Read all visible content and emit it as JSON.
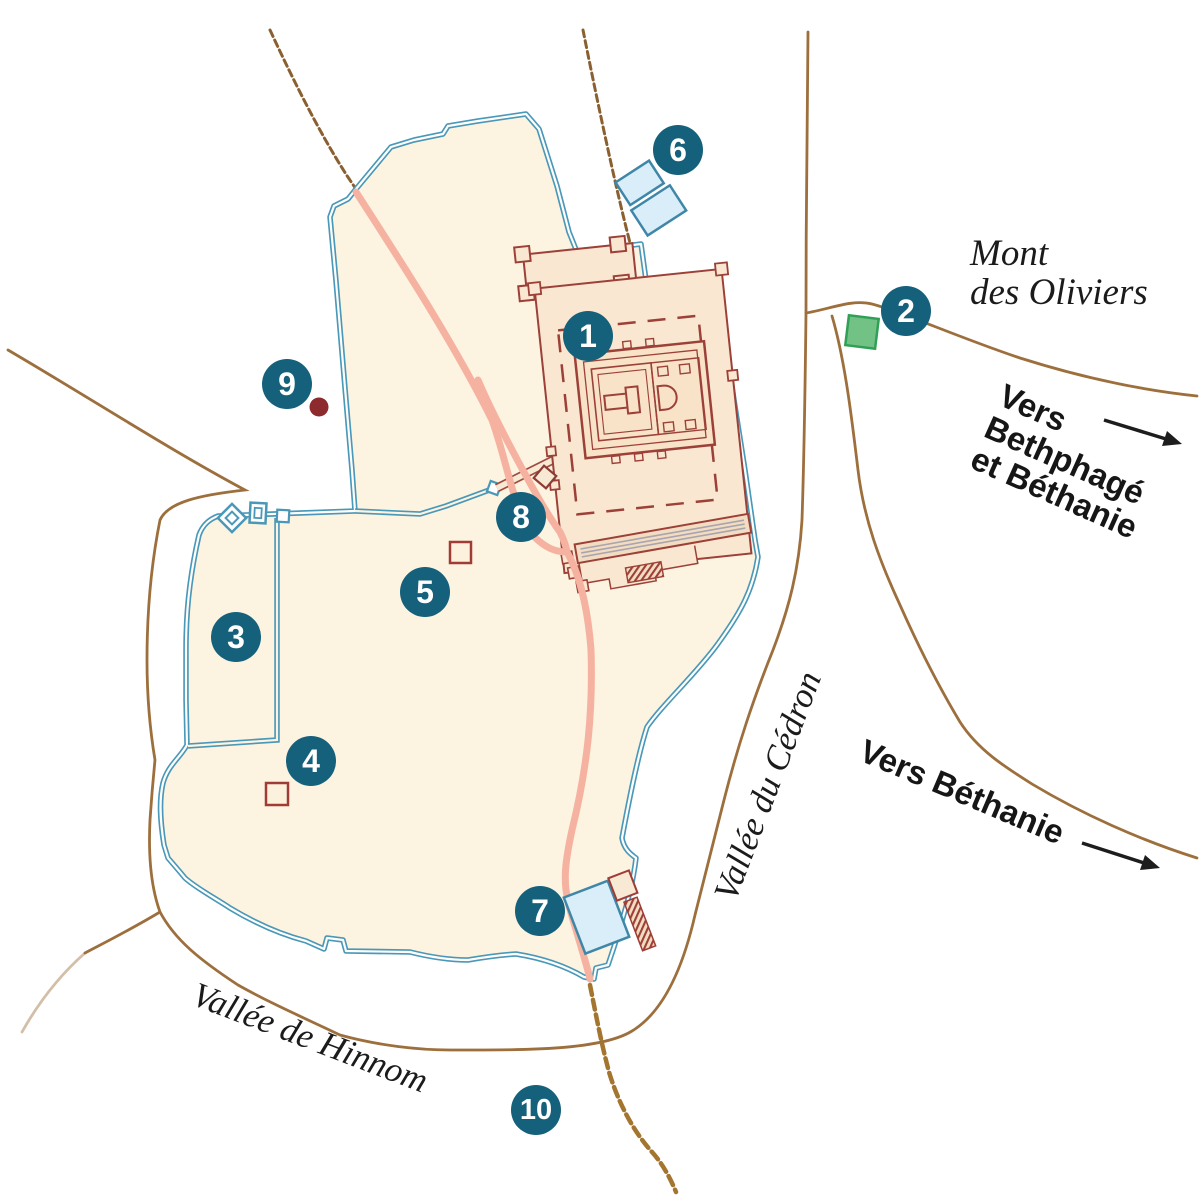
{
  "map": {
    "labels": {
      "mont_des_oliviers": [
        "Mont",
        "des Oliviers"
      ],
      "vers_bethphage_bethanie": [
        "Vers",
        "Bethphagé",
        "et Béthanie"
      ],
      "vers_bethanie": "Vers Béthanie",
      "vallee_du_cedron": "Vallée du Cédron",
      "vallee_de_hinnom": "Vallée de Hinnom"
    },
    "markers": [
      {
        "number": "1"
      },
      {
        "number": "2"
      },
      {
        "number": "3"
      },
      {
        "number": "4"
      },
      {
        "number": "5"
      },
      {
        "number": "6"
      },
      {
        "number": "7"
      },
      {
        "number": "8"
      },
      {
        "number": "9"
      },
      {
        "number": "10"
      }
    ],
    "colors": {
      "marker_background": "#15607b",
      "marker_text": "#ffffff",
      "city_fill": "#fdf3e1",
      "wall_blue": "#4a98b8",
      "temple_maroon": "#9c4038",
      "temple_fill": "#f9e7d1",
      "road_brown": "#9d6f3d",
      "road_dashed_brown": "#a3752f",
      "road_pink": "#f6b2a0",
      "pool_fill": "#daeefa",
      "pool_border": "#3f87a8",
      "green_square_fill": "#72c185",
      "green_square_border": "#2fa056",
      "red_dot": "#8c2a2e",
      "red_square_border": "#a03c36",
      "label_text": "#1b1b1b"
    },
    "symbols": [
      "temple-complex",
      "antonia-fortress",
      "royal-stoa",
      "twin-pools",
      "siloam-pool",
      "green-square",
      "red-square",
      "red-dot",
      "causeway",
      "wall-towers"
    ]
  }
}
